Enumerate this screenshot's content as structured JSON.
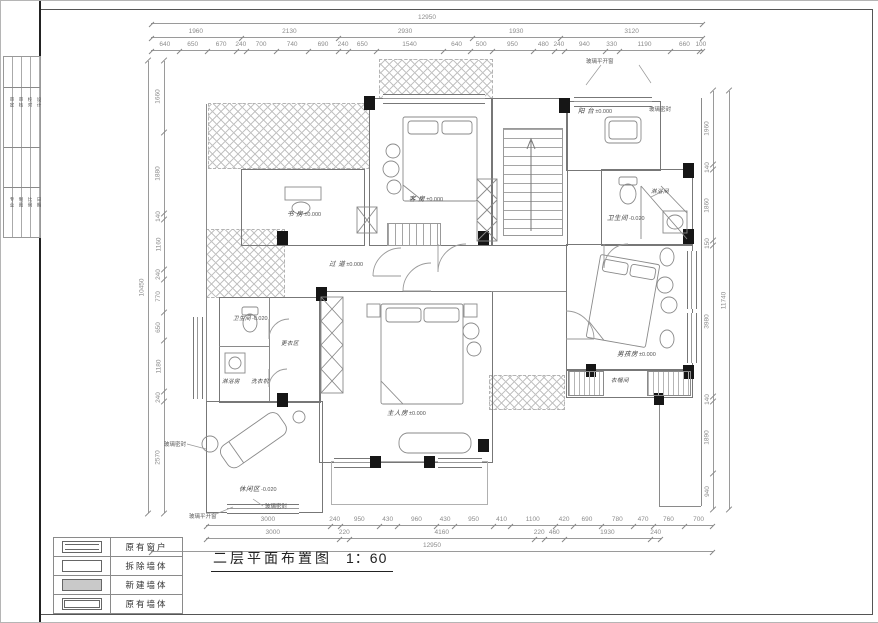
{
  "drawing_title": {
    "text": "二层平面布置图",
    "scale": "1：60"
  },
  "legend": {
    "items": [
      {
        "label": "原有窗户",
        "type": "window"
      },
      {
        "label": "拆除墙体",
        "type": "demolish"
      },
      {
        "label": "新建墙体",
        "type": "new"
      },
      {
        "label": "原有墙体",
        "type": "existing"
      }
    ]
  },
  "title_block": {
    "group1": [
      "审定",
      "审核",
      "校对",
      "设计"
    ],
    "group2": [
      "专业",
      "制图",
      "比例",
      "日期"
    ]
  },
  "dimensions": {
    "top": {
      "overall": "12950",
      "groups": [
        "1960",
        "2130",
        "2930",
        "1930",
        "3120"
      ],
      "details": [
        "640",
        "650",
        "670",
        "240",
        "700",
        "740",
        "690",
        "240",
        "650",
        "1540",
        "640",
        "500",
        "950",
        "480",
        "240",
        "940",
        "330",
        "1190",
        "660",
        "100"
      ]
    },
    "bottom": {
      "overall": "12950",
      "groups": [
        "3000",
        "220",
        "4160",
        "220",
        "460",
        "1930",
        "240"
      ],
      "details": [
        "3000",
        "240",
        "950",
        "430",
        "960",
        "430",
        "950",
        "410",
        "1100",
        "420",
        "690",
        "780",
        "470",
        "760",
        "700"
      ]
    },
    "left": {
      "overall": "10450",
      "details": [
        "1660",
        "1880",
        "140",
        "1160",
        "240",
        "770",
        "650",
        "1180",
        "240",
        "2570"
      ]
    },
    "right": {
      "overall": "11740",
      "details": [
        "1960",
        "140",
        "1860",
        "150",
        "3980",
        "140",
        "1890",
        "940"
      ]
    }
  },
  "rooms": {
    "guest": {
      "name": "客 房",
      "level": "±0.000"
    },
    "study": {
      "name": "书 房",
      "level": "±0.000"
    },
    "balcony": {
      "name": "阳 台",
      "level": "±0.000"
    },
    "bath_right": {
      "name": "卫生间",
      "level": "-0.020"
    },
    "shower_right": {
      "name": "淋浴间",
      "level": ""
    },
    "boy": {
      "name": "男孩房",
      "level": "±0.000"
    },
    "cloakroom": {
      "name": "衣帽间",
      "level": ""
    },
    "corridor": {
      "name": "过 道",
      "level": "±0.000"
    },
    "master": {
      "name": "主人房",
      "level": "±0.000"
    },
    "bath_left": {
      "name": "卫生间",
      "level": "-0.020"
    },
    "shower_left": {
      "name": "淋浴房",
      "level": ""
    },
    "laundry": {
      "name": "洗衣机",
      "level": ""
    },
    "dressing": {
      "name": "更衣区",
      "level": ""
    },
    "leisure": {
      "name": "休闲区",
      "level": "-0.020"
    }
  },
  "annotations": {
    "glass_casement_top": "玻璃平开窗",
    "glass_seal_right": "玻璃密封",
    "glass_seal_left": "玻璃密封",
    "glass_seal_bottom": "玻璃密封",
    "glass_casement_bottom": "玻璃平开窗"
  }
}
